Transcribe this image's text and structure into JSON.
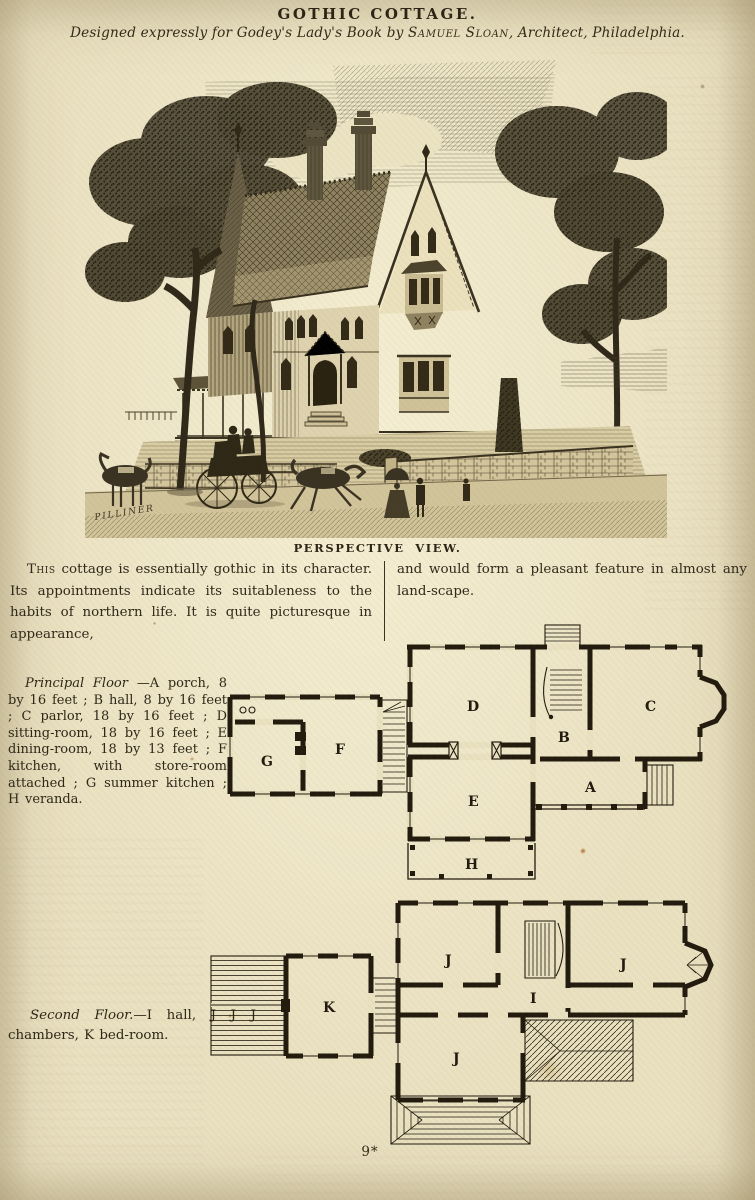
{
  "header": {
    "title": "GOTHIC COTTAGE.",
    "byline_pre": "Designed expressly for Godey's Lady's Book by ",
    "byline_name": "Samuel Sloan",
    "byline_post": ", Architect, Philadelphia."
  },
  "engraving": {
    "caption": "PERSPECTIVE VIEW.",
    "signature": "PILLINER"
  },
  "intro": {
    "lead": "This",
    "left_rest": " cottage is essentially gothic in its character.  Its appointments indicate its suitableness to the habits of northern life.  It is quite picturesque in appearance,",
    "right": "and would form a pleasant feature in almost any land-scape."
  },
  "principal_floor": {
    "lead": "Principal Floor",
    "text": " —A porch, 8 by 16 feet ; B hall, 8 by 16 feet ; C parlor, 18 by 16 feet ; D sitting-room, 18 by 16 feet ; E dining-room, 18 by 13 feet ; F kitchen, with store-room attached ; G summer kitchen ; H veranda."
  },
  "second_floor": {
    "lead": "Second Floor.",
    "text": "—I hall, J J J chambers, K bed-room."
  },
  "plans": {
    "principal": {
      "rooms": [
        {
          "label": "A"
        },
        {
          "label": "B"
        },
        {
          "label": "C"
        },
        {
          "label": "D"
        },
        {
          "label": "E"
        },
        {
          "label": "F"
        },
        {
          "label": "G"
        },
        {
          "label": "H"
        }
      ]
    },
    "second": {
      "rooms": [
        {
          "label": "I"
        },
        {
          "label": "J"
        },
        {
          "label": "J"
        },
        {
          "label": "J"
        },
        {
          "label": "K"
        }
      ]
    }
  },
  "footer": {
    "page_number": "9*"
  },
  "colors": {
    "paper": "#eae1c1",
    "ink": "#2c2414"
  }
}
